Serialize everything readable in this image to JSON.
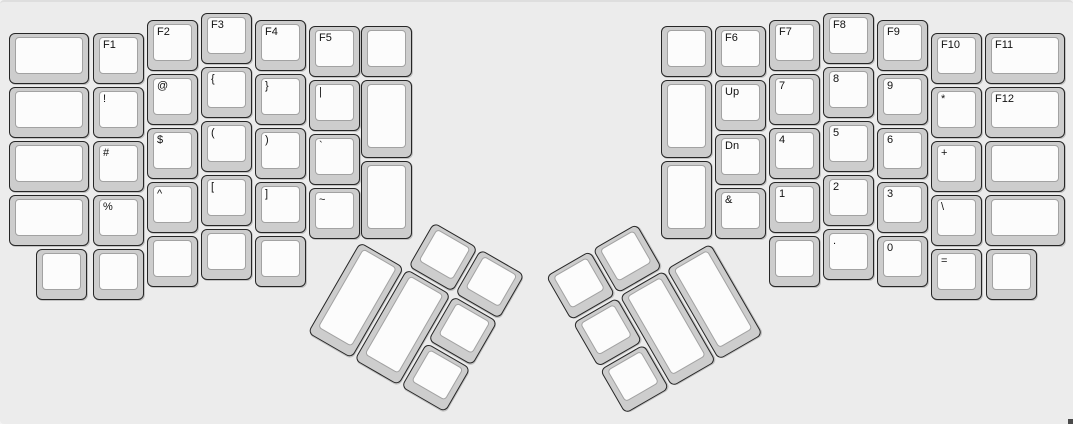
{
  "board": {
    "background_color": "#ececec",
    "key_cap_color": "#cdcdcd",
    "key_top_color": "#fcfcfc",
    "key_border_color": "#262626",
    "legend_color": "#111111",
    "unit_px": 54
  },
  "keyboard": {
    "groups": [
      {
        "name": "left-main",
        "x": 0,
        "y": 0,
        "angle": 0,
        "keys": [
          {
            "x": 9,
            "y": 31,
            "w": 80,
            "h": 51,
            "label": ""
          },
          {
            "x": 9,
            "y": 85,
            "w": 80,
            "h": 51,
            "label": ""
          },
          {
            "x": 9,
            "y": 139,
            "w": 80,
            "h": 51,
            "label": ""
          },
          {
            "x": 9,
            "y": 193,
            "w": 80,
            "h": 51,
            "label": ""
          },
          {
            "x": 93,
            "y": 31,
            "w": 51,
            "h": 51,
            "label": "F1"
          },
          {
            "x": 93,
            "y": 85,
            "w": 51,
            "h": 51,
            "label": "!"
          },
          {
            "x": 93,
            "y": 139,
            "w": 51,
            "h": 51,
            "label": "#"
          },
          {
            "x": 93,
            "y": 193,
            "w": 51,
            "h": 51,
            "label": "%"
          },
          {
            "x": 93,
            "y": 247,
            "w": 51,
            "h": 51,
            "label": ""
          },
          {
            "x": 147,
            "y": 18,
            "w": 51,
            "h": 51,
            "label": "F2"
          },
          {
            "x": 147,
            "y": 72,
            "w": 51,
            "h": 51,
            "label": "@"
          },
          {
            "x": 147,
            "y": 126,
            "w": 51,
            "h": 51,
            "label": "$"
          },
          {
            "x": 147,
            "y": 180,
            "w": 51,
            "h": 51,
            "label": "^"
          },
          {
            "x": 147,
            "y": 234,
            "w": 51,
            "h": 51,
            "label": ""
          },
          {
            "x": 201,
            "y": 11,
            "w": 51,
            "h": 51,
            "label": "F3"
          },
          {
            "x": 201,
            "y": 65,
            "w": 51,
            "h": 51,
            "label": "{"
          },
          {
            "x": 201,
            "y": 119,
            "w": 51,
            "h": 51,
            "label": "("
          },
          {
            "x": 201,
            "y": 173,
            "w": 51,
            "h": 51,
            "label": "["
          },
          {
            "x": 201,
            "y": 227,
            "w": 51,
            "h": 51,
            "label": ""
          },
          {
            "x": 255,
            "y": 18,
            "w": 51,
            "h": 51,
            "label": "F4"
          },
          {
            "x": 255,
            "y": 72,
            "w": 51,
            "h": 51,
            "label": "}"
          },
          {
            "x": 255,
            "y": 126,
            "w": 51,
            "h": 51,
            "label": ")"
          },
          {
            "x": 255,
            "y": 180,
            "w": 51,
            "h": 51,
            "label": "]"
          },
          {
            "x": 255,
            "y": 234,
            "w": 51,
            "h": 51,
            "label": ""
          },
          {
            "x": 309,
            "y": 24,
            "w": 51,
            "h": 51,
            "label": "F5"
          },
          {
            "x": 309,
            "y": 78,
            "w": 51,
            "h": 51,
            "label": "|"
          },
          {
            "x": 309,
            "y": 132,
            "w": 51,
            "h": 51,
            "label": "`"
          },
          {
            "x": 309,
            "y": 186,
            "w": 51,
            "h": 51,
            "label": "~"
          },
          {
            "x": 361,
            "y": 24,
            "w": 51,
            "h": 51,
            "label": ""
          },
          {
            "x": 361,
            "y": 78,
            "w": 51,
            "h": 78,
            "label": ""
          },
          {
            "x": 361,
            "y": 159,
            "w": 51,
            "h": 78,
            "label": ""
          },
          {
            "x": 36,
            "y": 247,
            "w": 51,
            "h": 51,
            "label": ""
          }
        ]
      },
      {
        "name": "right-main",
        "x": 0,
        "y": 0,
        "angle": 0,
        "keys": [
          {
            "x": 661,
            "y": 24,
            "w": 51,
            "h": 51,
            "label": ""
          },
          {
            "x": 661,
            "y": 78,
            "w": 51,
            "h": 78,
            "label": ""
          },
          {
            "x": 661,
            "y": 159,
            "w": 51,
            "h": 78,
            "label": ""
          },
          {
            "x": 715,
            "y": 24,
            "w": 51,
            "h": 51,
            "label": "F6"
          },
          {
            "x": 715,
            "y": 78,
            "w": 51,
            "h": 51,
            "label": "Up"
          },
          {
            "x": 715,
            "y": 132,
            "w": 51,
            "h": 51,
            "label": "Dn"
          },
          {
            "x": 715,
            "y": 186,
            "w": 51,
            "h": 51,
            "label": "&"
          },
          {
            "x": 769,
            "y": 18,
            "w": 51,
            "h": 51,
            "label": "F7"
          },
          {
            "x": 769,
            "y": 72,
            "w": 51,
            "h": 51,
            "label": "7"
          },
          {
            "x": 769,
            "y": 126,
            "w": 51,
            "h": 51,
            "label": "4"
          },
          {
            "x": 769,
            "y": 180,
            "w": 51,
            "h": 51,
            "label": "1"
          },
          {
            "x": 769,
            "y": 234,
            "w": 51,
            "h": 51,
            "label": ""
          },
          {
            "x": 823,
            "y": 11,
            "w": 51,
            "h": 51,
            "label": "F8"
          },
          {
            "x": 823,
            "y": 65,
            "w": 51,
            "h": 51,
            "label": "8"
          },
          {
            "x": 823,
            "y": 119,
            "w": 51,
            "h": 51,
            "label": "5"
          },
          {
            "x": 823,
            "y": 173,
            "w": 51,
            "h": 51,
            "label": "2"
          },
          {
            "x": 823,
            "y": 227,
            "w": 51,
            "h": 51,
            "label": "."
          },
          {
            "x": 877,
            "y": 18,
            "w": 51,
            "h": 51,
            "label": "F9"
          },
          {
            "x": 877,
            "y": 72,
            "w": 51,
            "h": 51,
            "label": "9"
          },
          {
            "x": 877,
            "y": 126,
            "w": 51,
            "h": 51,
            "label": "6"
          },
          {
            "x": 877,
            "y": 180,
            "w": 51,
            "h": 51,
            "label": "3"
          },
          {
            "x": 877,
            "y": 234,
            "w": 51,
            "h": 51,
            "label": "0"
          },
          {
            "x": 931,
            "y": 31,
            "w": 51,
            "h": 51,
            "label": "F10"
          },
          {
            "x": 931,
            "y": 85,
            "w": 51,
            "h": 51,
            "label": "*"
          },
          {
            "x": 931,
            "y": 139,
            "w": 51,
            "h": 51,
            "label": "+"
          },
          {
            "x": 931,
            "y": 193,
            "w": 51,
            "h": 51,
            "label": "\\"
          },
          {
            "x": 931,
            "y": 247,
            "w": 51,
            "h": 51,
            "label": "="
          },
          {
            "x": 985,
            "y": 31,
            "w": 80,
            "h": 51,
            "label": "F11"
          },
          {
            "x": 985,
            "y": 85,
            "w": 80,
            "h": 51,
            "label": "F12"
          },
          {
            "x": 985,
            "y": 139,
            "w": 80,
            "h": 51,
            "label": ""
          },
          {
            "x": 985,
            "y": 193,
            "w": 80,
            "h": 51,
            "label": ""
          },
          {
            "x": 986,
            "y": 247,
            "w": 51,
            "h": 51,
            "label": ""
          }
        ]
      },
      {
        "name": "left-thumb",
        "x": 360,
        "y": 240,
        "angle": 30,
        "keys": [
          {
            "x": 54,
            "y": -54,
            "w": 51,
            "h": 51,
            "label": ""
          },
          {
            "x": 108,
            "y": -54,
            "w": 51,
            "h": 51,
            "label": ""
          },
          {
            "x": 0,
            "y": 0,
            "w": 51,
            "h": 105,
            "label": ""
          },
          {
            "x": 54,
            "y": 0,
            "w": 51,
            "h": 105,
            "label": ""
          },
          {
            "x": 108,
            "y": 0,
            "w": 51,
            "h": 51,
            "label": ""
          },
          {
            "x": 108,
            "y": 54,
            "w": 51,
            "h": 51,
            "label": ""
          }
        ]
      },
      {
        "name": "right-thumb",
        "x": 713,
        "y": 240,
        "angle": -30,
        "keys": [
          {
            "x": -162,
            "y": -54,
            "w": 51,
            "h": 51,
            "label": ""
          },
          {
            "x": -108,
            "y": -54,
            "w": 51,
            "h": 51,
            "label": ""
          },
          {
            "x": -162,
            "y": 0,
            "w": 51,
            "h": 51,
            "label": ""
          },
          {
            "x": -108,
            "y": 0,
            "w": 51,
            "h": 105,
            "label": ""
          },
          {
            "x": -54,
            "y": 0,
            "w": 51,
            "h": 105,
            "label": ""
          },
          {
            "x": -162,
            "y": 54,
            "w": 51,
            "h": 51,
            "label": ""
          }
        ]
      }
    ]
  }
}
